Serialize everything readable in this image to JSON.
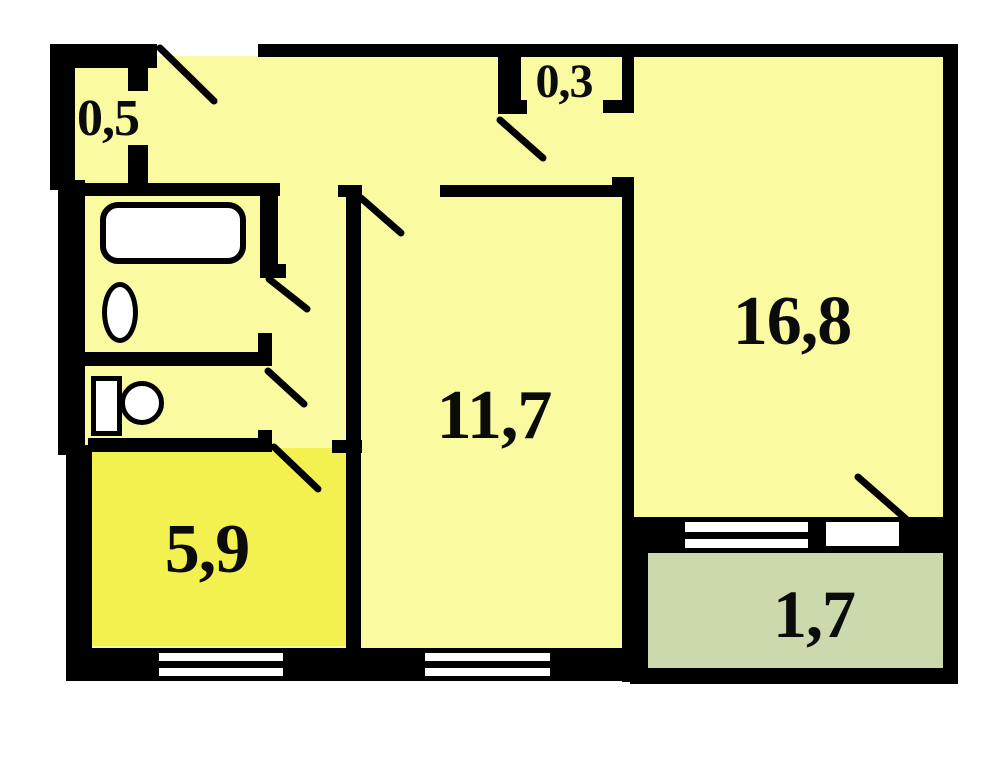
{
  "plan": {
    "type": "apartment-floor-plan",
    "rooms": {
      "hall_closet": {
        "name": "hall-closet",
        "area": "0,5"
      },
      "mezzanine": {
        "name": "mezzanine-closet",
        "area": "0,3"
      },
      "living_room": {
        "name": "living-room",
        "area": "16,8"
      },
      "bedroom": {
        "name": "bedroom",
        "area": "11,7"
      },
      "kitchen": {
        "name": "kitchen",
        "area": "5,9"
      },
      "balcony": {
        "name": "balcony",
        "area": "1,7"
      }
    },
    "colors": {
      "room_fill": "#FAFAA0",
      "kitchen_fill": "#F3F150",
      "balcony_fill": "#CCD9AC",
      "wall": "#000000",
      "fixture_fill": "#FFFFFF",
      "background": "#FFFFFF",
      "label_text": "#0B0B0B"
    }
  }
}
